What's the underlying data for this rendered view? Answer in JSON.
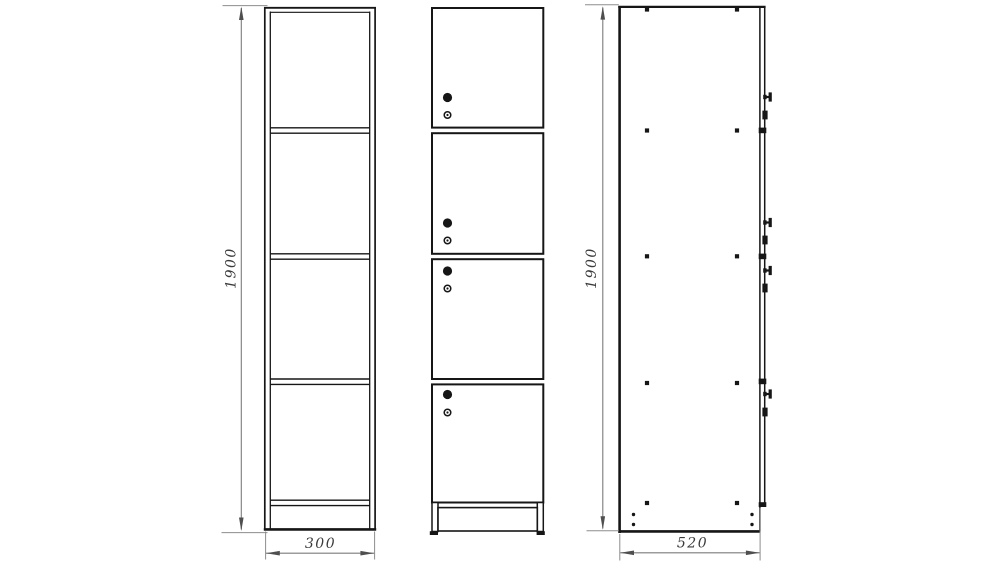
{
  "drawing": {
    "dimension_labels": {
      "front_height": "1900",
      "front_width": "300",
      "side_height": "1900",
      "side_depth": "520"
    },
    "colors": {
      "line": "#161616",
      "dimension_line": "#7c7c7c",
      "dimension_text": "#3a3a3a",
      "background": "#ffffff"
    }
  }
}
